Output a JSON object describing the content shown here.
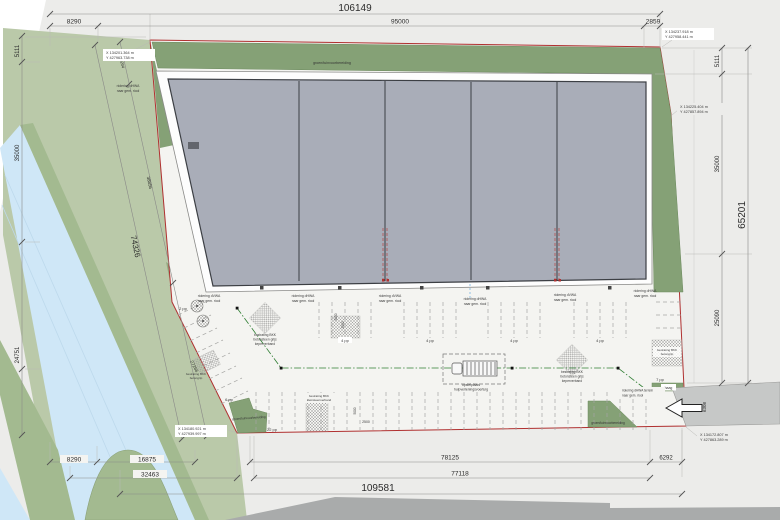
{
  "drawing": {
    "dims": {
      "top_total": "106149",
      "top_a": "8290",
      "top_b": "95000",
      "top_c": "2859",
      "left_a": "5111",
      "left_b": "35000",
      "left_c": "24751",
      "diag_a": "8204",
      "diag_b": "38856",
      "diag_total": "74326",
      "diag_c": "27266",
      "right_a": "5111",
      "right_b": "35000",
      "right_c": "25090",
      "right_total": "65201",
      "road_width": "6308",
      "bottom_a": "8290",
      "bottom_b": "16875",
      "bottom_c": "32463",
      "bottom_d": "78125",
      "bottom_e": "77118",
      "bottom_total": "109581",
      "bottom_f": "6292",
      "stall_depth": "5000",
      "stall_half": "2500"
    },
    "coords": {
      "tl1": "X 134201.364 m",
      "tl2": "Y 427963.738 m",
      "tr1": "X 134237.918 m",
      "tr2": "Y 427958.441 m",
      "mr1": "X 134225.404 m",
      "mr2": "Y 427857.894 m",
      "bl1": "X 134180.921 m",
      "bl2": "Y 427939.997 m",
      "br1": "X 134172.807 m",
      "br2": "Y 427863.289 m"
    },
    "labels": {
      "green": "groen/tuinvoorbereiding",
      "hedge": "haag",
      "sewer_dvwa": "riolering dVWA",
      "sewer_dhwa": "riolering dHWA",
      "sewer_to": "naar gem. riool",
      "sewer_terrain": "riolering dHWA terrein",
      "paving1_1": "bestrating BKK",
      "paving1_2": "betonsteen grijs",
      "paving1_3": "keperverband",
      "paving2_2": "betongrip",
      "paving2_3": "kleinsteenverband",
      "truck1": "opstelplaats",
      "truck2": "hulpverleningsvoertuig"
    },
    "parking": {
      "p2": "2 pp",
      "p4": "4 pp",
      "p6": "6 pp",
      "p7": "7 pp",
      "p22": "22 pp"
    },
    "colors": {
      "water": "#cfe7f7",
      "bank_green": "#a3ba90",
      "field_green": "#bac9a9",
      "plot_green": "#85a176",
      "building_gray": "#a9adb8",
      "boundary_red": "#b03030",
      "road_dark": "#a9abab",
      "road_mid": "#c6c8c7",
      "utility_green": "#2e7d32"
    }
  }
}
